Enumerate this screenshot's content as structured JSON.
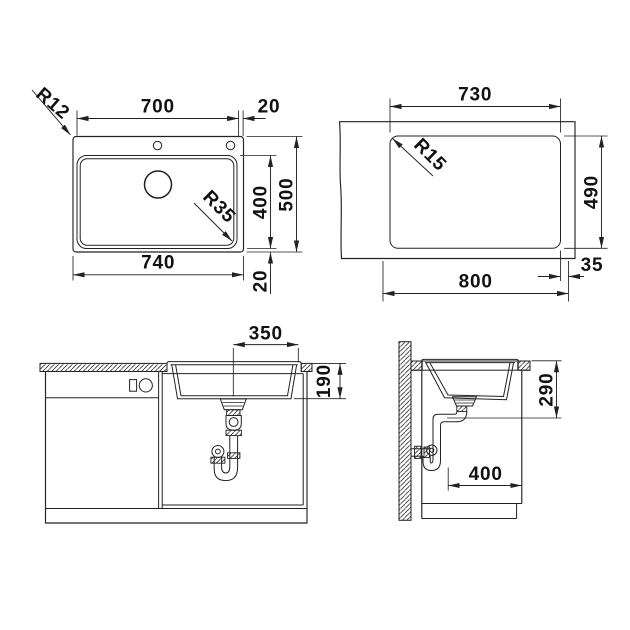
{
  "drawing": {
    "background": "#ffffff",
    "line_color": "#222222",
    "text_color": "#111111",
    "kind": "sink installation dimension drawing"
  },
  "views": {
    "top": {
      "corner_radius": "R12",
      "bowl_radius": "R35",
      "bowl_width": "700",
      "tap_edge_offset": "20",
      "bowl_height": "400",
      "overall_height": "500",
      "overall_width": "740",
      "bowl_bottom_offset": "20"
    },
    "cutout": {
      "cutout_width": "730",
      "corner_radius": "R15",
      "cutout_height": "490",
      "min_cabinet_width": "800",
      "edge_distance": "35"
    },
    "front": {
      "drain_to_edge": "350",
      "bowl_depth": "190"
    },
    "side": {
      "outlet_height": "290",
      "outlet_clearance": "400"
    }
  }
}
